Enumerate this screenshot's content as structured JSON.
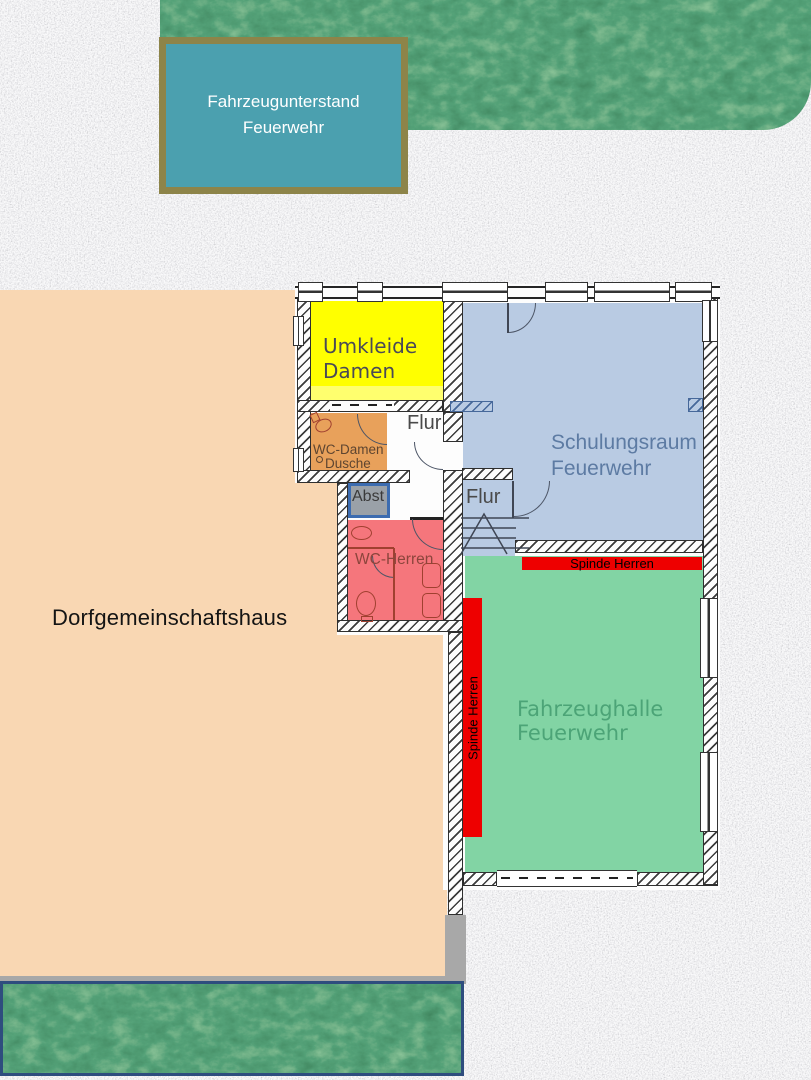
{
  "shed": {
    "line1": "Fahrzeugunterstand",
    "line2": "Feuerwehr"
  },
  "building": {
    "label": "Dorfgemeinschaftshaus"
  },
  "rooms": {
    "umkleide": {
      "line1": "Umkleide",
      "line2": "Damen"
    },
    "wc_damen": {
      "line1": "WC-Damen",
      "line2": "Dusche"
    },
    "flur_upper": {
      "label": "Flur"
    },
    "flur_lower": {
      "label": "Flur"
    },
    "abst": {
      "label": "Abst"
    },
    "wc_herren": {
      "label": "WC-Herren"
    },
    "schulungsraum": {
      "line1": "Schulungsraum",
      "line2": "Feuerwehr"
    },
    "fahrzeughalle": {
      "line1": "Fahrzeughalle",
      "line2": "Feuerwehr"
    },
    "spinde_top": {
      "label": "Spinde Herren"
    },
    "spinde_side": {
      "label": "Spinde Herren"
    }
  },
  "colors": {
    "granite_base": "#c9c9c9",
    "lawn_green": "#1d5a37",
    "shed_fill": "#4ba0af",
    "shed_border": "#8d8449",
    "building_fill": "#f9d7b3",
    "building_border_gray": "#a8a8a8",
    "lawn_border_navy": "#2e4d7e",
    "room_yellow": "#ffff00",
    "room_yellow_light": "#ffff6e",
    "room_orange": "#e8a15b",
    "room_blue": "#b9cbe3",
    "abst_gray": "#9aa1a8",
    "abst_border": "#3c6cb0",
    "room_red": "#f5767c",
    "hall_green": "#82d4a4",
    "locker_red": "#ee0000",
    "label_dark": "#4a4a57",
    "label_flur": "#4a4a4a",
    "label_slate": "#5d7ba3",
    "label_hall_green": "#4ca477",
    "label_wc_damen": "#5e4530",
    "label_wc_herren": "#8c453c"
  }
}
